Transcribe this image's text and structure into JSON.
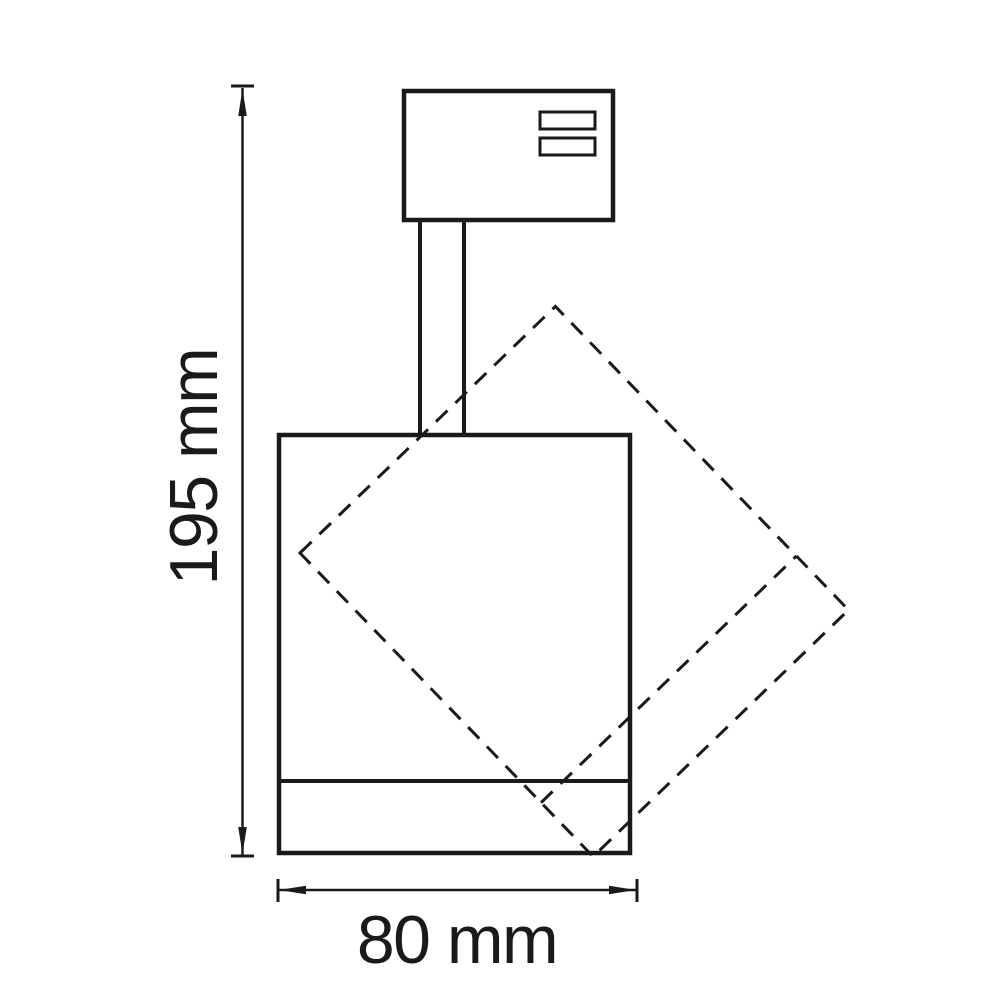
{
  "drawing": {
    "background_color": "#ffffff",
    "line_color": "#1a1a1a",
    "dimensions": {
      "height": {
        "label": "195 mm",
        "value": 195,
        "unit": "mm"
      },
      "width": {
        "label": "80 mm",
        "value": 80,
        "unit": "mm"
      }
    }
  }
}
